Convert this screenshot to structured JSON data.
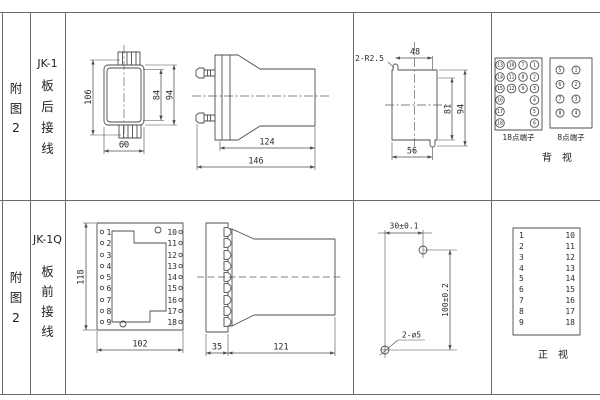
{
  "colors": {
    "background": "#ffffff",
    "line": "#4d4d4d",
    "text": "#1f1f1f"
  },
  "top_row": {
    "fig_chars": [
      "附",
      "图",
      "2"
    ],
    "model": "JK-1",
    "wiring_chars": [
      "板",
      "后",
      "接",
      "线"
    ],
    "rear_outline": {
      "height_total": "106",
      "height_inner": "84",
      "height_outer": "94",
      "width": "60"
    },
    "side_view": {
      "body_length": "124",
      "total_length": "146"
    },
    "panel_cutout": {
      "corner_radius": "2-R2.5",
      "top_width": "48",
      "height_inner": "81",
      "height_total": "94",
      "bottom_width": "56"
    },
    "terminal_18": {
      "label": "18点端子",
      "numbers": [
        "13",
        "10",
        "7",
        "1",
        "14",
        "11",
        "8",
        "2",
        "15",
        "12",
        "9",
        "3",
        "16",
        "4",
        "17",
        "5",
        "18",
        "6"
      ]
    },
    "terminal_8": {
      "label": "8点端子",
      "numbers": [
        "5",
        "1",
        "6",
        "2",
        "7",
        "3",
        "8",
        "4"
      ]
    },
    "view_label": "背　视"
  },
  "bottom_row": {
    "fig_chars": [
      "附",
      "图",
      "2"
    ],
    "model": "JK-1Q",
    "wiring_chars": [
      "板",
      "前",
      "接",
      "线"
    ],
    "front_view": {
      "height": "118",
      "width": "102",
      "left_pins": [
        "1",
        "2",
        "3",
        "4",
        "5",
        "6",
        "7",
        "8",
        "9"
      ],
      "right_pins": [
        "10",
        "11",
        "12",
        "13",
        "14",
        "15",
        "16",
        "17",
        "18"
      ]
    },
    "side_view": {
      "plate": "35",
      "body": "121"
    },
    "drill_plan": {
      "hole_spacing_h": "30±0.1",
      "hole_spacing_v": "100±0.2",
      "hole_note": "2-ø5"
    },
    "pin_table": {
      "left": [
        "1",
        "2",
        "3",
        "4",
        "5",
        "6",
        "7",
        "8",
        "9"
      ],
      "right": [
        "10",
        "11",
        "12",
        "13",
        "14",
        "15",
        "16",
        "17",
        "18"
      ]
    },
    "view_label": "正　视"
  }
}
